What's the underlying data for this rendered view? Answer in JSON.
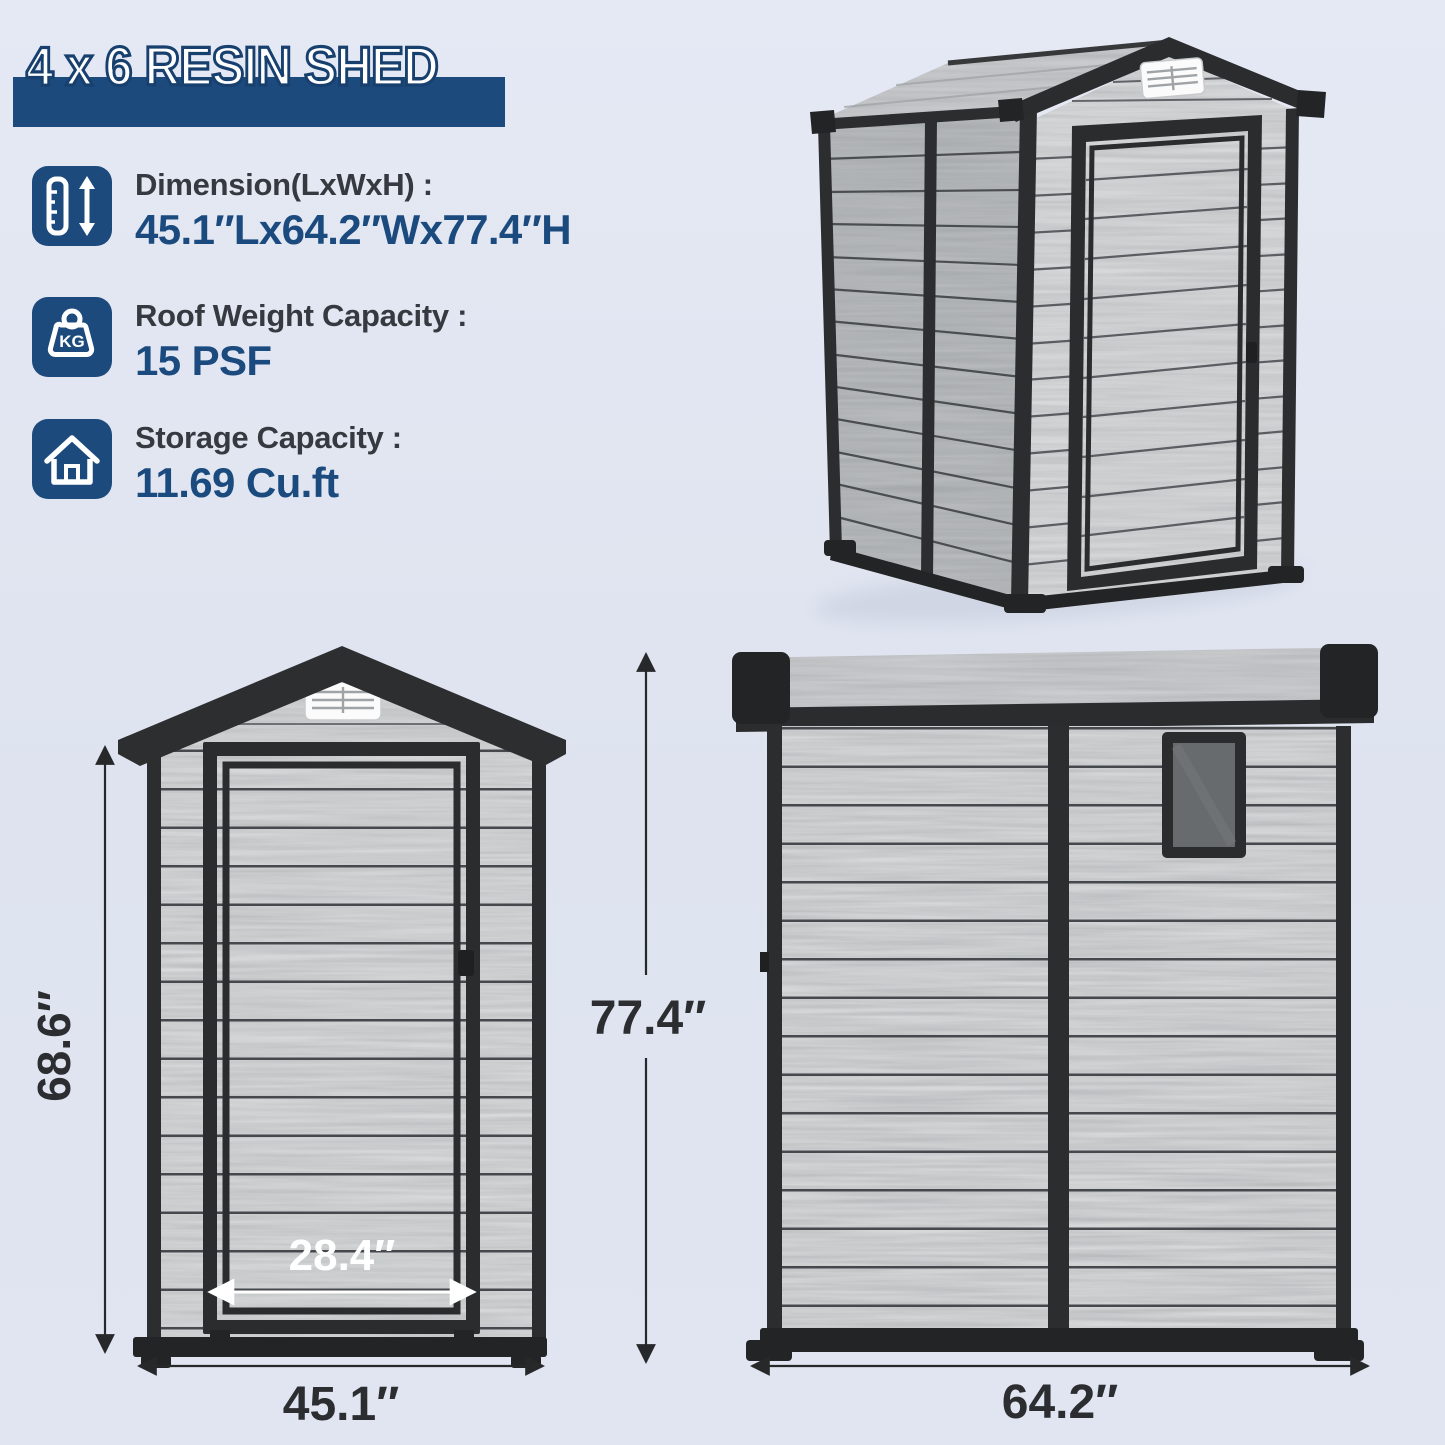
{
  "header": {
    "title": "4 x 6 RESIN SHED"
  },
  "specs": [
    {
      "icon": "height-dimension-icon",
      "label": "Dimension(LxWxH) :",
      "value": "45.1″Lx64.2″Wx77.4″H"
    },
    {
      "icon": "weight-kg-icon",
      "icon_text": "KG",
      "label": "Roof Weight Capacity :",
      "value": "15 PSF"
    },
    {
      "icon": "house-storage-icon",
      "label": "Storage Capacity :",
      "value": "11.69 Cu.ft"
    }
  ],
  "views": {
    "perspective": {
      "description": "3d-shed-view"
    },
    "front": {
      "height_label": "68.6″",
      "door_width_label": "28.4″",
      "width_label": "45.1″",
      "overall_height_label": "77.4″"
    },
    "side": {
      "width_label": "64.2″"
    }
  },
  "colors": {
    "accent_navy": "#1c4a7d",
    "frame_dark": "#2c2d2f",
    "panel_light": "#d8dadb",
    "panel_shadow": "#c3c5c7",
    "background": "#e0e5f1"
  }
}
